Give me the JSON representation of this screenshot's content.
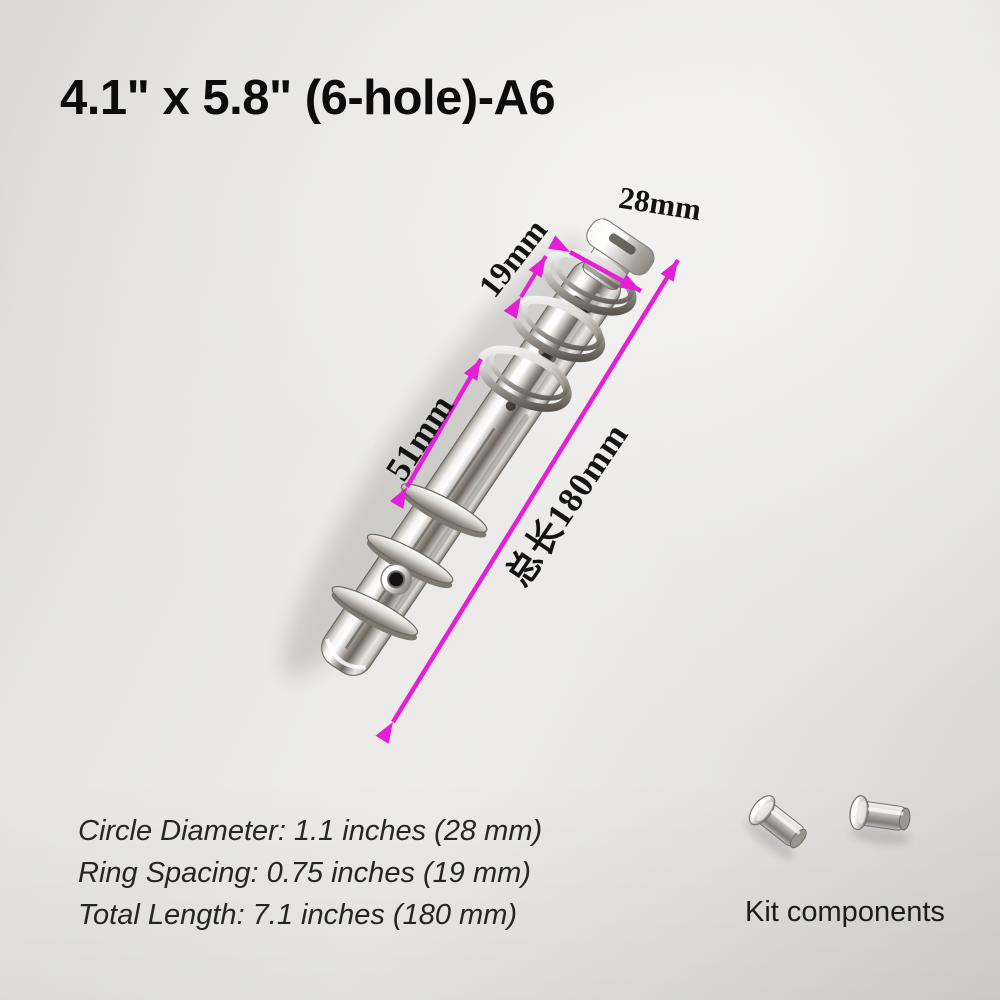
{
  "product": {
    "title": "4.1\" x 5.8\" (6-hole)-A6",
    "subject": "6-ring A6 binder clip mechanism, silver chrome metal"
  },
  "annotations": {
    "ring_diameter": "28mm",
    "ring_spacing": "19mm",
    "middle_gap": "51mm",
    "total_length": "总长180mm"
  },
  "specs": {
    "line1": "Circle Diameter: 1.1 inches (28 mm)",
    "line2": "Ring Spacing: 0.75 inches (19 mm)",
    "line3": "Total Length: 7.1 inches (180 mm)"
  },
  "kit": {
    "label": "Kit components",
    "items": "2 metal rivets"
  },
  "colors": {
    "dimension_accent": "#e51ed8",
    "background": "#e3e2e0",
    "metal": "#d9d6d1"
  }
}
